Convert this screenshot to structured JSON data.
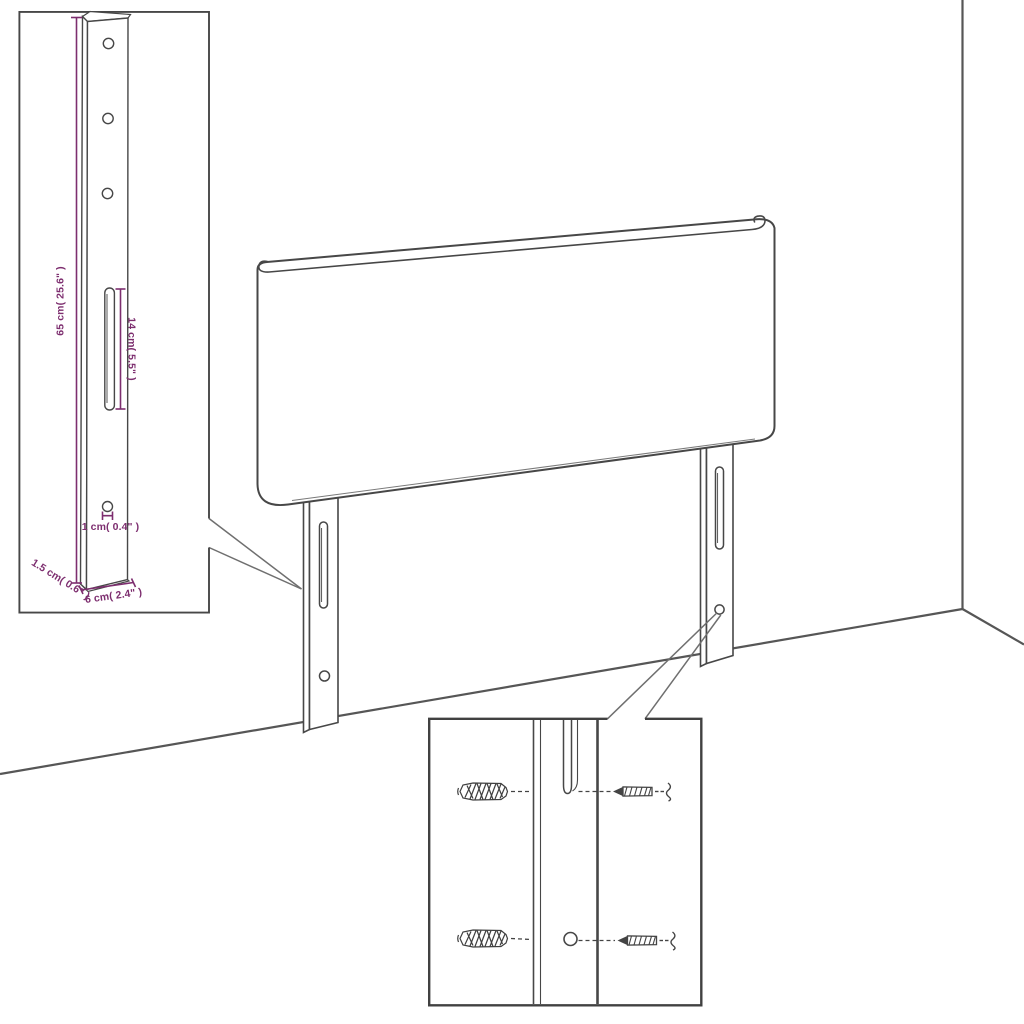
{
  "diagram_title": "headboard-dimension-diagram",
  "colors": {
    "accent_purple": "#7D2E6F",
    "line_gray": "#474747",
    "background": "#FFFFFF"
  },
  "labels": {
    "height": "65 cm( 25.6\" )",
    "slot_length": "14 cm( 5.5\" )",
    "hole_diameter": "1 cm( 0.4\" )",
    "thickness": "1.5 cm( 0.6\" )",
    "leg_width": "6 cm( 2.4\" )"
  }
}
